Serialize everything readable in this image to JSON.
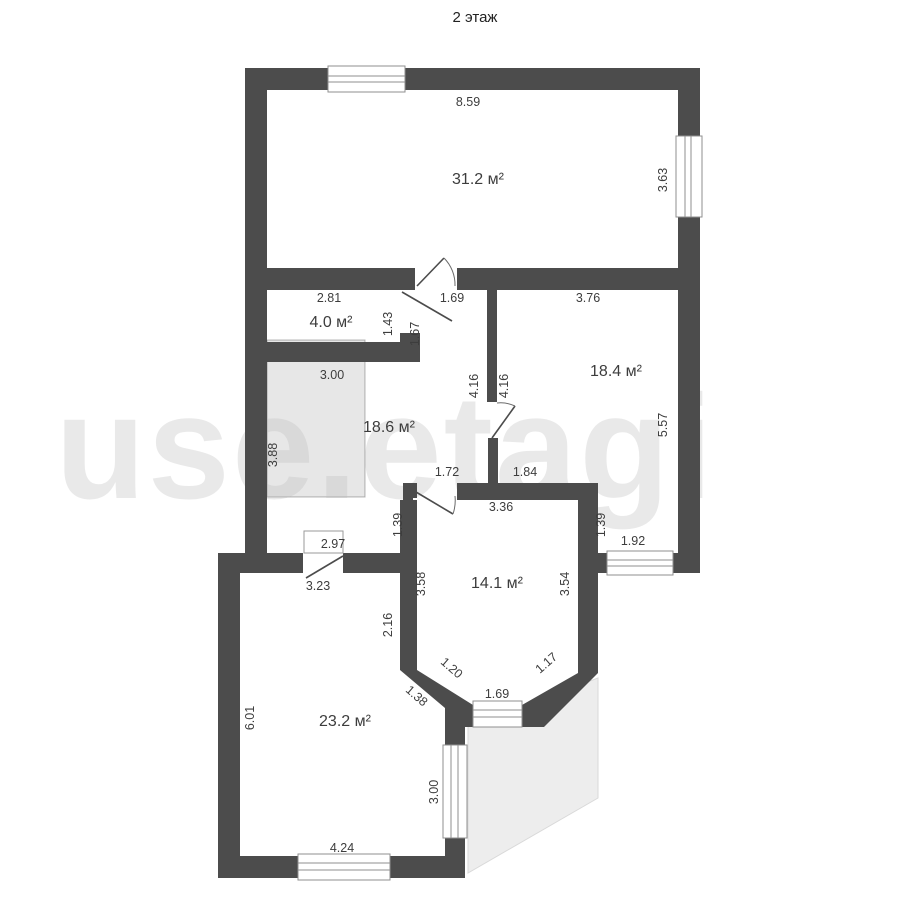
{
  "title": "2 этаж",
  "watermark": "use.etagi",
  "colors": {
    "wall": "#4c4c4c",
    "roof_fill": "#ededed",
    "roof_stroke": "#d9d9d9",
    "stair_fill": "rgba(0,0,0,0.095)",
    "stair_stroke": "rgba(0,0,0,0.28)"
  },
  "rooms": {
    "living": "31.2 м²",
    "wc": "4.0 м²",
    "hall": "18.6 м²",
    "bedroom1": "18.4 м²",
    "middle_room": "14.1 м²",
    "bedroom2": "23.2 м²"
  },
  "dims": {
    "living_width": "8.59",
    "living_window_right": "3.63",
    "wc_width": "2.81",
    "living_door": "1.69",
    "bedroom1_top": "3.76",
    "wc_height": "1.43",
    "wc_door": "1.67",
    "stair_width": "3.00",
    "hall_wall_416": "4.16",
    "bedroom1_wall_416": "4.16",
    "bedroom1_right": "5.57",
    "stair_height": "3.88",
    "pass_left": "1.72",
    "pass_right": "1.84",
    "middle_room_top": "3.36",
    "drop_left": "1.39",
    "drop_right": "1.39",
    "bedroom1_window": "1.92",
    "hall_bottom": "2.97",
    "bedroom2_top": "3.23",
    "middle_room_left": "3.58",
    "middle_room_right": "3.54",
    "bedroom2_right_upper": "2.16",
    "bedroom2_left": "6.01",
    "bay_left": "1.20",
    "bay_right": "1.17",
    "bay_window": "1.69",
    "bay_lower": "1.38",
    "bedroom2_window_right": "3.00",
    "bedroom2_bottom": "4.24"
  }
}
